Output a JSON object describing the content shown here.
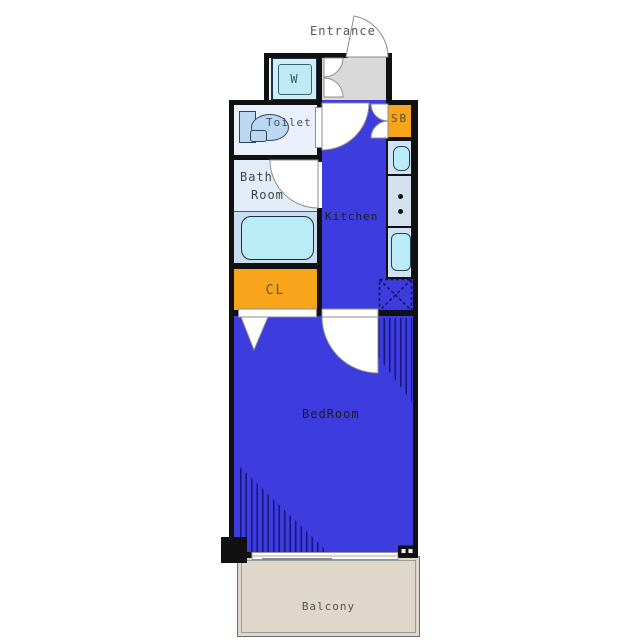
{
  "floorplan": {
    "rooms": {
      "entrance": {
        "label": "Entrance"
      },
      "washer": {
        "label": "W"
      },
      "toilet": {
        "label": "Toilet"
      },
      "bath": {
        "line1": "Bath",
        "line2": "Room"
      },
      "kitchen": {
        "label": "Kitchen"
      },
      "shoebox": {
        "label": "SB"
      },
      "closet": {
        "label": "CL"
      },
      "bedroom": {
        "label": "BedRoom"
      },
      "balcony": {
        "label": "Balcony"
      }
    },
    "colors": {
      "room_blue": "#3d3cdf",
      "accent_orange": "#f9a51b",
      "light_room_blue": "#eaf0fb",
      "bath_room_blue": "#e3edfa",
      "wet_area_blue": "#c9dcf2",
      "fixture_cyan": "#b9ecf4",
      "fixture_blue": "#bcd7f0",
      "entrance_gray": "#d9d9d9",
      "balcony_beige": "#ded7ca",
      "wall": "#111111",
      "hatch_line": "#15157a"
    }
  }
}
